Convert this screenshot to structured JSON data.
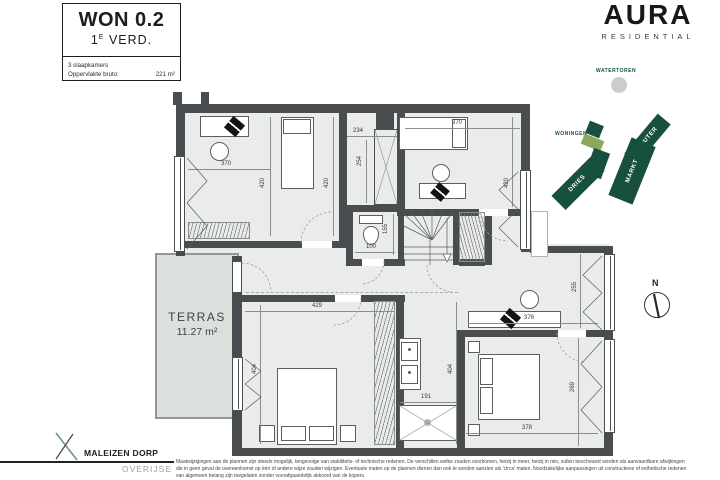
{
  "title_block": {
    "unit": "WON 0.2",
    "floor_num": "1",
    "floor_sup": "E",
    "floor_word": "VERD.",
    "rooms": "3 slaapkamers",
    "area_label": "Oppervlakte bruto:",
    "area_value": "221 m²"
  },
  "brand": {
    "name": "AURA",
    "tagline": "RESIDENTIAL"
  },
  "site_map": {
    "watertoren": "WATERTOREN",
    "woningen": "WONINGEN",
    "dries": "DRIES",
    "markt": "MARKT",
    "kouter": "KOUTER"
  },
  "compass": {
    "north": "N"
  },
  "plan": {
    "terrace_name": "TERRAS",
    "terrace_area": "11.27 m²",
    "dims": {
      "room1_w": "370",
      "room1_h": "420",
      "dressing_h": "420",
      "dressing_w": "234",
      "shaft_h": "254",
      "room2_w": "370",
      "room2_h": "420",
      "wc_h": "155",
      "wc_w": "100",
      "master_w": "429",
      "master_h": "404",
      "bath_h": "404",
      "shower_w": "191",
      "desk_w": "378",
      "office_h": "255",
      "bed3_w": "378",
      "bed3_h": "269"
    }
  },
  "footer": {
    "logo_title": "MALEIZEN DORP",
    "logo_sub": "OVERIJSE",
    "disclaimer": [
      "Maatwijzigingen aan de plannen zijn steeds mogelijk, tengevolge van stabiliteits- of technische redenen. De verschillen welke zouden voorkomen, hetzij in meer, hetzij in min, zullen beschouwd worden als aanvaardbare afwijkingen",
      "die in geen geval de overeenkomst op één of andere wijze zouden wijzigen. Eventuele maten op de plannen dienen dan ook te worden aanzien als 'circa' maten. Noodzakelijke aanpassingen uit constructieve of esthetische redenen",
      "van algemeen belang zijn toegelaten zonder voorafgaandelijk akkoord van de kopers."
    ]
  },
  "colors": {
    "wall": "#494D4F",
    "room_fill": "#EAEBEB",
    "terrace_fill": "#DCE0DD",
    "site_green": "#17503F",
    "site_highlight": "#8CA95B",
    "tower_gray": "#C9CDCC"
  }
}
